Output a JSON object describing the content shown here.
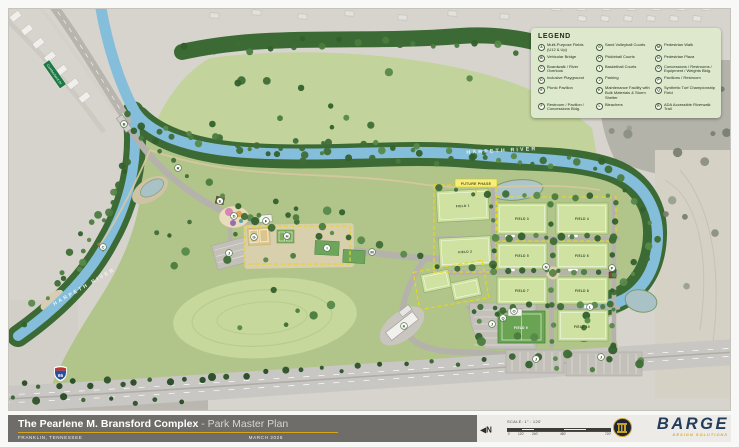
{
  "legend": {
    "title": "LEGEND",
    "items": [
      {
        "letter": "A",
        "label": "Multi-Purpose Fields (U12 & Up)"
      },
      {
        "letter": "B",
        "label": "Vehicular Bridge"
      },
      {
        "letter": "C",
        "label": "Boardwalk / River Overlook"
      },
      {
        "letter": "D",
        "label": "Inclusive Playground"
      },
      {
        "letter": "E",
        "label": "Picnic Pavilion"
      },
      {
        "letter": "F",
        "label": "Restroom / Pavilion / Concessions Bldg."
      },
      {
        "letter": "G",
        "label": "Sand Volleyball Courts"
      },
      {
        "letter": "H",
        "label": "Pickleball Courts"
      },
      {
        "letter": "I",
        "label": "Basketball Courts"
      },
      {
        "letter": "J",
        "label": "Parking"
      },
      {
        "letter": "K",
        "label": "Maintenance Facility with Bulk Materials & Storm Shelter"
      },
      {
        "letter": "L",
        "label": "Bleachers"
      },
      {
        "letter": "M",
        "label": "Pedestrian Walk"
      },
      {
        "letter": "N",
        "label": "Pedestrian Plaza"
      },
      {
        "letter": "O",
        "label": "Concessions / Restrooms / Equipment / Weights Bldg."
      },
      {
        "letter": "P",
        "label": "Pavilions / Restroom"
      },
      {
        "letter": "Q",
        "label": "Synthetic Turf Championship Field"
      },
      {
        "letter": "R",
        "label": "ADA Accessible Riverwalk Trail"
      }
    ]
  },
  "map": {
    "river_label_top": "HARPETH RIVER",
    "river_label_left": "HARPETH RIVER",
    "future_phase": "FUTURE PHASE",
    "road_sign": "Cumberland Dr",
    "interstate": "65",
    "fields": [
      {
        "label": "FIELD 1"
      },
      {
        "label": "FIELD 2"
      },
      {
        "label": "FIELD 3"
      },
      {
        "label": "FIELD 4"
      },
      {
        "label": "FIELD 5"
      },
      {
        "label": "FIELD 6"
      },
      {
        "label": "FIELD 7"
      },
      {
        "label": "FIELD 8"
      },
      {
        "label": "FIELD 9"
      },
      {
        "label": "FIELD 10"
      }
    ],
    "markers": [
      {
        "letter": "B"
      },
      {
        "letter": "R"
      },
      {
        "letter": "C"
      },
      {
        "letter": "E"
      },
      {
        "letter": "D"
      },
      {
        "letter": "F"
      },
      {
        "letter": "G"
      },
      {
        "letter": "H"
      },
      {
        "letter": "I"
      },
      {
        "letter": "J"
      },
      {
        "letter": "M"
      },
      {
        "letter": "K"
      },
      {
        "letter": "N"
      },
      {
        "letter": "O"
      },
      {
        "letter": "L"
      },
      {
        "letter": "Q"
      },
      {
        "letter": "J"
      },
      {
        "letter": "J"
      },
      {
        "letter": "J"
      },
      {
        "letter": "P"
      }
    ]
  },
  "footer": {
    "title_bold": "The Pearlene M. Bransford Complex",
    "title_sep": " - ",
    "title_light": "Park Master Plan",
    "location": "FRANKLIN, TENNESSEE",
    "date": "MARCH 2025",
    "north": "N",
    "scale_label": "SCALE: 1\" : 120'",
    "scale_ticks": [
      "0'",
      "120'",
      "240'",
      "480'",
      "720'"
    ],
    "brand": "BARGE",
    "brand_tagline": "DESIGN SOLUTIONS"
  }
}
